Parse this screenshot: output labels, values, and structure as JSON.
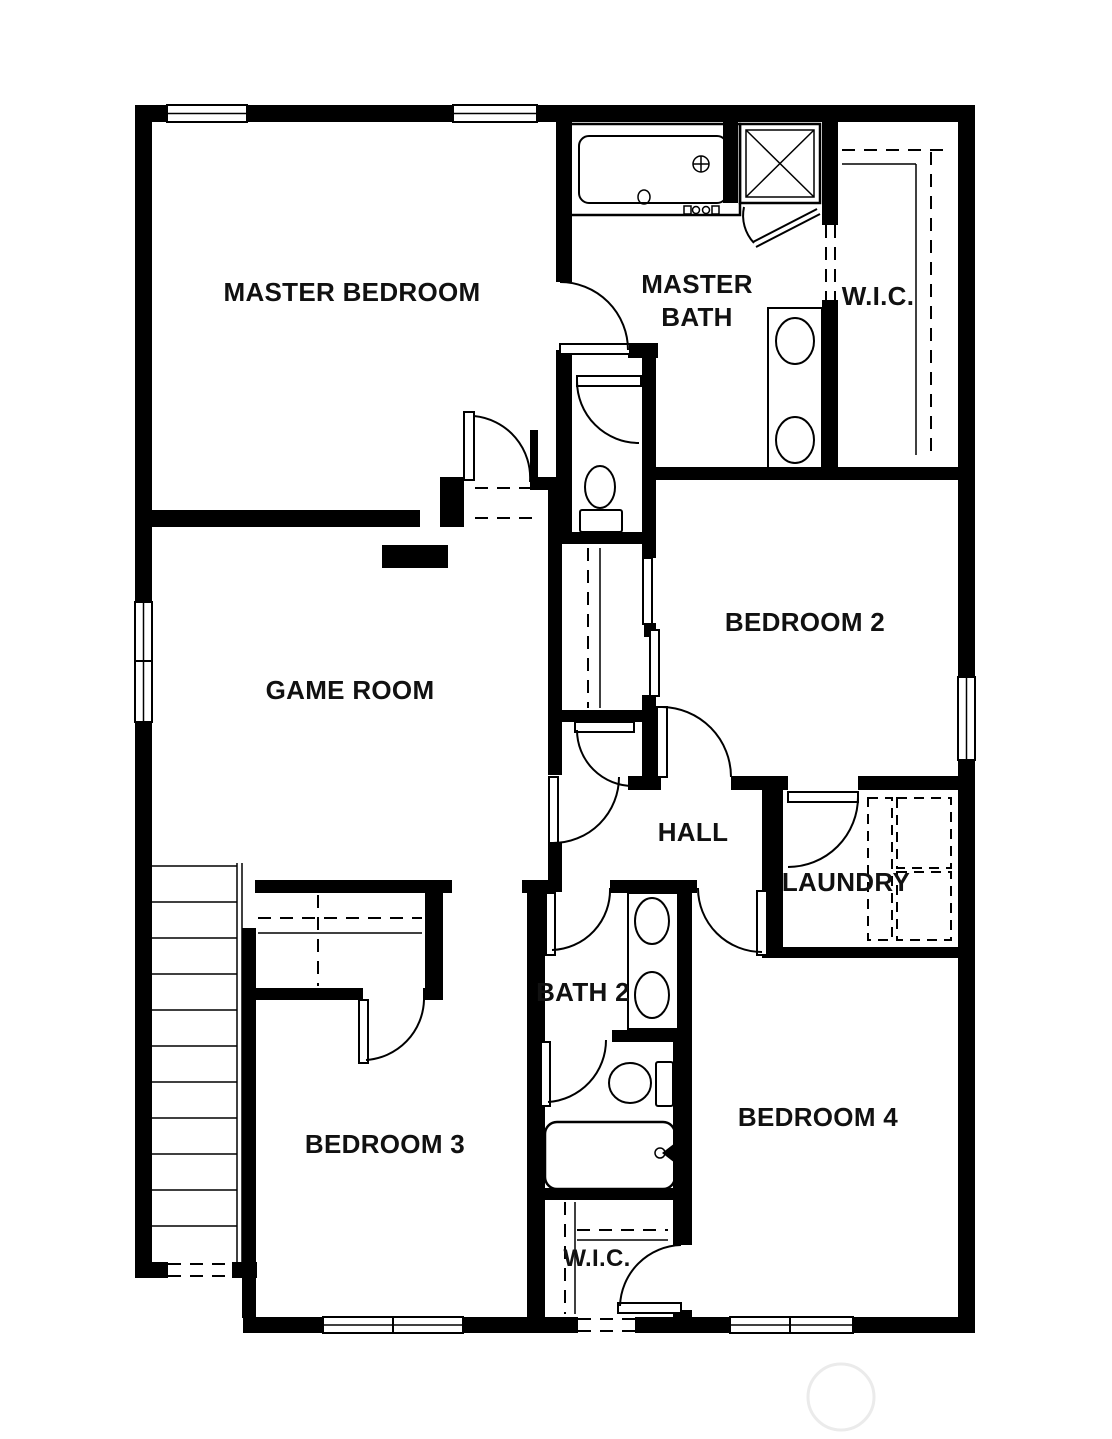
{
  "floorplan": {
    "rooms": {
      "master_bedroom": {
        "label": "MASTER BEDROOM"
      },
      "master_bath": {
        "label_line1": "MASTER",
        "label_line2": "BATH"
      },
      "wic_master": {
        "label": "W.I.C."
      },
      "game_room": {
        "label": "GAME ROOM"
      },
      "bedroom2": {
        "label": "BEDROOM 2"
      },
      "hall": {
        "label": "HALL"
      },
      "laundry": {
        "label": "LAUNDRY"
      },
      "bath2": {
        "label": "BATH 2"
      },
      "bedroom3": {
        "label": "BEDROOM 3"
      },
      "bedroom4": {
        "label": "BEDROOM 4"
      },
      "wic_bedroom4": {
        "label": "W.I.C."
      }
    },
    "colors": {
      "wall": "#000000",
      "background": "#ffffff",
      "watermark": "#ebebeb"
    },
    "fixtures": [
      "garden-tub",
      "walk-in-shower",
      "double-vanity-master",
      "water-closet-toilet",
      "bypass-closet-doors",
      "washer-dryer",
      "double-vanity-bath2",
      "toilet-bath2",
      "bathtub-bath2",
      "staircase"
    ]
  }
}
